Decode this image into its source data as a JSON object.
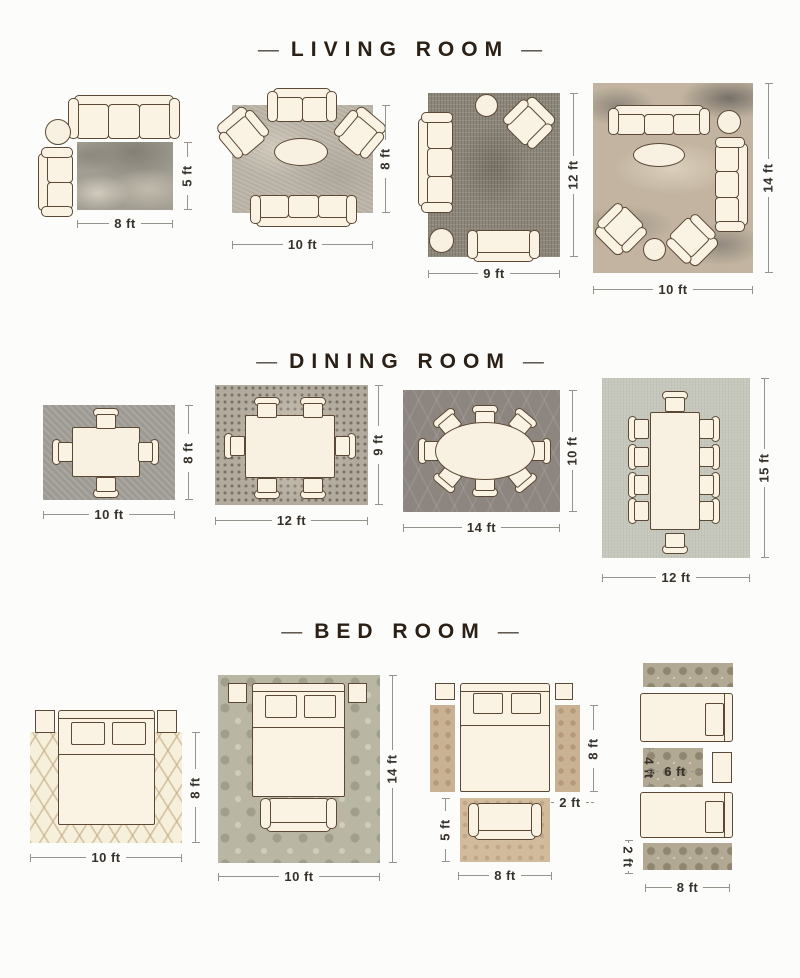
{
  "ui": {
    "dash": "—"
  },
  "colors": {
    "furniture_fill": "#faf3e3",
    "furniture_outline": "#5b4835",
    "title_text": "#2b2015",
    "dimension_text": "#36312a",
    "dimension_line": "#94948c"
  },
  "sections": [
    {
      "title": "LIVING ROOM",
      "layouts": [
        {
          "width": "8 ft",
          "height": "5 ft"
        },
        {
          "width": "10 ft",
          "height": "8 ft"
        },
        {
          "width": "9 ft",
          "height": "12 ft"
        },
        {
          "width": "10 ft",
          "height": "14 ft"
        }
      ]
    },
    {
      "title": "DINING ROOM",
      "layouts": [
        {
          "width": "10 ft",
          "height": "8 ft"
        },
        {
          "width": "12 ft",
          "height": "9 ft"
        },
        {
          "width": "14 ft",
          "height": "10 ft"
        },
        {
          "width": "12 ft",
          "height": "15 ft"
        }
      ]
    },
    {
      "title": "BED ROOM",
      "layouts": [
        {
          "width": "10 ft",
          "height": "8 ft"
        },
        {
          "width": "10 ft",
          "height": "14 ft"
        },
        {
          "width": "8 ft",
          "runner_length": "8 ft",
          "runner_width": "2 ft",
          "front_rug_height": "5 ft"
        },
        {
          "width": "8 ft",
          "mid_rug_height": "4 ft",
          "mid_rug_width": "6 ft",
          "runner_width": "2 ft"
        }
      ]
    }
  ]
}
